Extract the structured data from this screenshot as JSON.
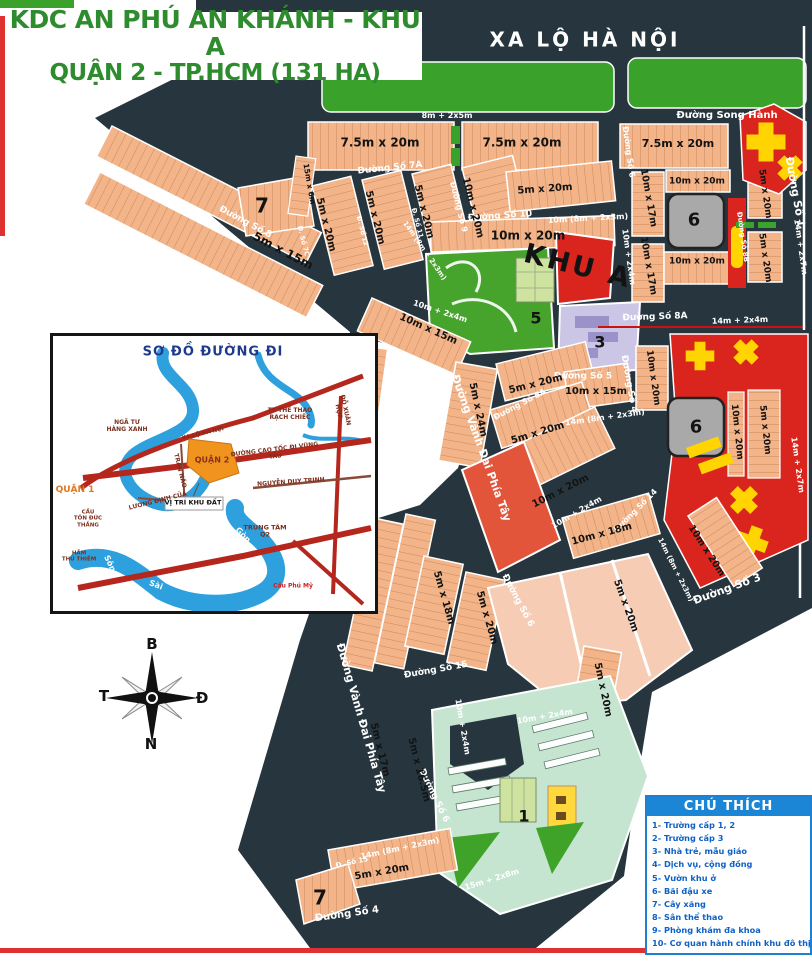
{
  "title": {
    "line1": "KDC AN PHÚ AN KHÁNH - KHU A",
    "line2": "QUẬN 2 - TP.HCM (131 HA)"
  },
  "labels": {
    "xa_lo_ha_noi": "XA LỘ HÀ NỘI",
    "duong_song_hanh": "Đường Song Hành",
    "duong_so_1": "Đường Số 1",
    "duong_so_3": "Đường Số 3",
    "duong_so_4": "Đường Số 4",
    "duong_so_5": "Đường Số 5",
    "duong_so_5a": "Đường Số 5A",
    "duong_so_6": "Đường Số 6",
    "duong_so_7a": "Đường Số 7A",
    "d_so_7c": "Đ. Số 7C",
    "duong_so_8": "Đường Số 8",
    "duong_so_8a": "Đường Số 8A",
    "duong_so_8b": "Đường Số 8B",
    "duong_so_9": "Đường Số 9",
    "duong_so_10": "Đường Số 10",
    "d_so_11": "Đ. Số 11",
    "d_so_12": "Đ. Số 12",
    "duong_so_14": "Đường Số 14",
    "duong_so_15": "Đường Số 15",
    "d_so_15": "Đ. Số 15",
    "vanh_dai": "Đường Vành Đai Phía Tây",
    "dim_8_2x5m": "8m + 2x5m",
    "dim_10_8m_2x3m": "10m (8m + 2x3m)",
    "dim_14_8m_2x3m": "14m (8m + 2x3m)",
    "dim_10_2x4m": "10m + 2x4m",
    "dim_14_2x4m": "14m + 2x4m",
    "dim_14_2x7m": "14m + 2x7m",
    "dim_15_2x8m": "15m + 2x8m",
    "lot_75x20": "7.5m x 20m",
    "lot_5x20": "5m x 20m",
    "lot_10x20": "10m x 20m",
    "lot_10x17": "10m x 17m",
    "lot_10x15": "10m x 15m",
    "lot_5x15": "5m x 15m",
    "lot_15x6": "15m x 6m",
    "lot_5x24": "5m x 24m",
    "lot_10x18": "10m x 18m",
    "lot_5x18": "5m x 18m",
    "lot_5x17": "5m x 17m",
    "lot_5x16_5": "5m x 16.5m",
    "khu_a": "KHU A",
    "n1": "1",
    "n3": "3",
    "n5": "5",
    "n6": "6",
    "n7": "7"
  },
  "compass": {
    "north": "B",
    "south": "N",
    "west": "T",
    "east": "Đ"
  },
  "inset": {
    "title": "SƠ ĐỒ ĐƯỜNG ĐI",
    "nga_tu_hang_xanh": "NGÃ TƯ\nHÀNG XANH",
    "tt_the_thao": "TT THỂ THAO\nRẠCH CHIẾC",
    "quan_2": "QUẬN 2",
    "quan_1": "QUẬN 1",
    "cau_ton_duc_thang": "CẦU\nTÔN ĐỨC\nTHẮNG",
    "ham_thu_thiem": "HẦM\nTHỦ THIÊM",
    "vi_tri_khu_dat": "VỊ TRÍ KHU ĐẤT",
    "cao_toc": "ĐƯỜNG CAO TỐC ĐI VŨNG TÀU",
    "nguyen_duy_trinh": "NGUYỄN DUY TRINH",
    "trung_tam_q2": "TRUNG TÂM\nQ2",
    "cau_phu_my": "Cầu Phú Mỹ",
    "do_xuan_hop": "ĐỖ XUÂN HỢP",
    "tran_nao": "TRẦN NÃO",
    "luong_dinh_cua": "LƯƠNG ĐỊNH CỦA",
    "xa_lo_ha_noi_small": "XA LỘ HÀ NỘI",
    "song": "Sông",
    "sai": "Sài",
    "gon": "Gòn"
  },
  "legend": {
    "title": "CHÚ THÍCH",
    "items": [
      "1- Trường cấp 1, 2",
      "2- Trường cấp 3",
      "3- Nhà trẻ, mẫu giáo",
      "4- Dịch vụ, cộng đồng",
      "5- Vườn khu ở",
      "6- Bãi đậu xe",
      "7- Cây xăng",
      "8- Sân thể thao",
      "9- Phòng khám đa khoa",
      "10- Cơ quan hành chính khu đô thị"
    ]
  }
}
